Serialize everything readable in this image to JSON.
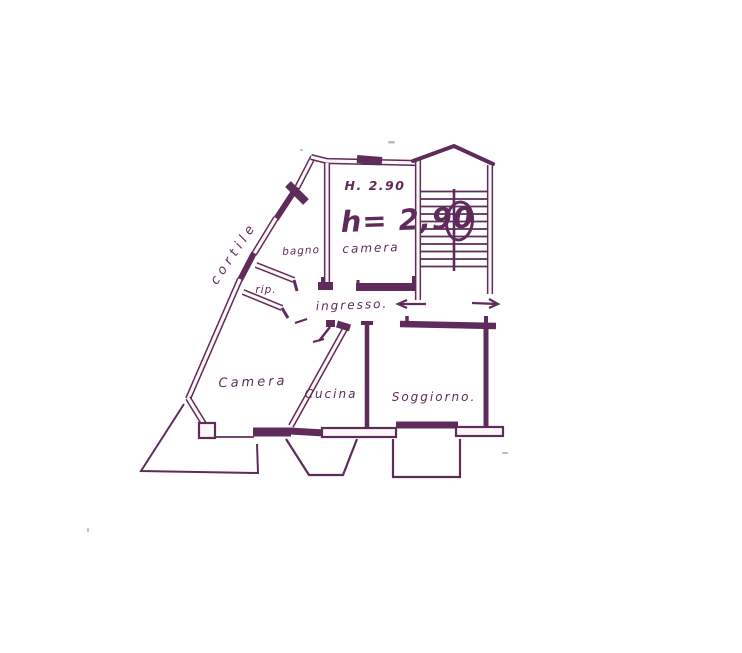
{
  "document": {
    "type": "hand-drawn floor plan sketch (scan)"
  },
  "colors": {
    "ink": "#5e2b5a",
    "paper": "#ffffff"
  },
  "labels": {
    "cortile": "cortile",
    "bagno": "bagno",
    "rip": "rip.",
    "camera_top": "camera",
    "height_printed": "H. 2.90",
    "height_hand": "h= 2,90",
    "ingresso": "ingresso.",
    "camera_main": "Camera",
    "cucina": "Cucina",
    "soggiorno": "Soggiorno."
  }
}
